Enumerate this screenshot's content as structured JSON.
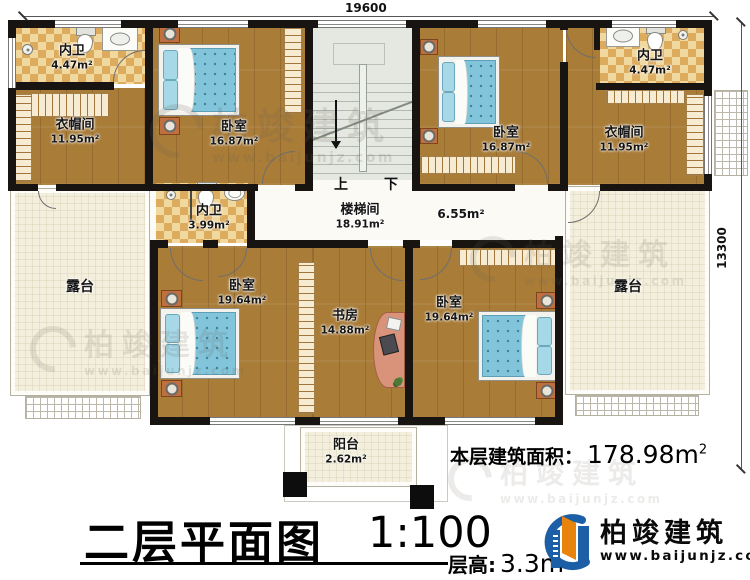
{
  "dimensions": {
    "width_top": "19600",
    "height_right": "13300"
  },
  "rooms": {
    "bath_tl": {
      "name": "内卫",
      "area": "4.47m²"
    },
    "wic_l": {
      "name": "衣帽间",
      "area": "11.95m²"
    },
    "bedroom_tl": {
      "name": "卧室",
      "area": "16.87m²"
    },
    "bedroom_tr": {
      "name": "卧室",
      "area": "16.87m²"
    },
    "bath_tr": {
      "name": "内卫",
      "area": "4.47m²"
    },
    "wic_r": {
      "name": "衣帽间",
      "area": "11.95m²"
    },
    "bath_mid": {
      "name": "内卫",
      "area": "3.99m²"
    },
    "stair_hall": {
      "name": "楼梯间",
      "area": "18.91m²"
    },
    "hall": {
      "area": "6.55m²"
    },
    "terrace_l": {
      "name": "露台"
    },
    "terrace_r": {
      "name": "露台"
    },
    "bedroom_bl": {
      "name": "卧室",
      "area": "19.64m²"
    },
    "study": {
      "name": "书房",
      "area": "14.88m²"
    },
    "bedroom_br": {
      "name": "卧室",
      "area": "19.64m²"
    },
    "balcony": {
      "name": "阳台",
      "area": "2.62m²"
    }
  },
  "stairs": {
    "up_label": "上",
    "down_label": "下"
  },
  "footer": {
    "title": "二层平面图",
    "scale": "1:100",
    "floor_height_label": "层高:",
    "floor_height_value": "3.3m",
    "total_area_label": "本层建筑面积：",
    "total_area_value": "178.98m",
    "total_area_sup": "2"
  },
  "brand": {
    "name": "柏竣建筑",
    "url": "www.baijunjz.com"
  },
  "watermark": {
    "name": "柏竣建筑",
    "url": "www.baijunjz.com"
  },
  "colors": {
    "wood": "#a97c38",
    "tile": "#dcab5e",
    "terrace": "#f3efdc",
    "stair": "#e4e8e0",
    "bed": "#82c4da",
    "brand_blue": "#1d5fa6",
    "brand_orange": "#e8830c"
  }
}
